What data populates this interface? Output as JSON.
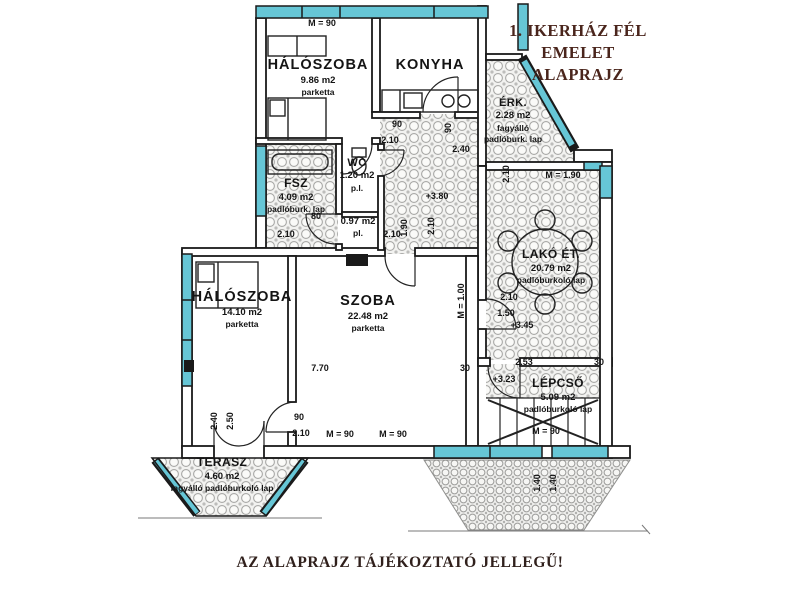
{
  "title": {
    "line1": "1. IKERHÁZ FÉL",
    "line2": "EMELET",
    "line3": "ALAPRAJZ"
  },
  "footer": {
    "disclaimer": "AZ ALAPRAJZ TÁJÉKOZTATÓ JELLEGŰ!"
  },
  "colors": {
    "window_glass": "#66c6d6",
    "wall_ink": "#1a1a1a",
    "title_ink": "#4a251c",
    "footer_ink": "#30201c",
    "tile_hatch": "#a8a8a6",
    "paper": "#ffffff"
  },
  "rooms": [
    {
      "id": "haloszoba-1",
      "name": "HÁLÓSZOBA",
      "area": "9.86 m2",
      "floor": "parketta",
      "x": 318,
      "y": 56,
      "cls": "lg"
    },
    {
      "id": "konyha",
      "name": "KONYHA",
      "x": 430,
      "y": 56,
      "cls": "lg"
    },
    {
      "id": "erkely",
      "name": "ÉRK.",
      "area": "2.28 m2",
      "floor": "fagyálló padlóburk. lap",
      "x": 513,
      "y": 96,
      "cls": "",
      "w": 64
    },
    {
      "id": "furdoszoba",
      "name": "FSZ",
      "area": "4.09 m2",
      "floor": "padlóburk. lap",
      "x": 296,
      "y": 176,
      "cls": "md",
      "w": 80
    },
    {
      "id": "wc",
      "name": "WC",
      "area": "1.20 m2",
      "floor": "p.l.",
      "x": 357,
      "y": 156,
      "cls": ""
    },
    {
      "id": "kamra",
      "area": "0.97 m2",
      "floor": "pl.",
      "x": 358,
      "y": 216,
      "cls": ""
    },
    {
      "id": "lako-etkezo",
      "name": "LAKÓ ÉT.",
      "area": "20.79 m2",
      "floor": "padlóburkoló lap",
      "x": 551,
      "y": 247,
      "cls": "md"
    },
    {
      "id": "haloszoba-2",
      "name": "HÁLÓSZOBA",
      "area": "14.10 m2",
      "floor": "parketta",
      "x": 242,
      "y": 288,
      "cls": "lg"
    },
    {
      "id": "szoba",
      "name": "SZOBA",
      "area": "22.48 m2",
      "floor": "parketta",
      "x": 368,
      "y": 292,
      "cls": "lg"
    },
    {
      "id": "lepcso",
      "name": "LÉPCSŐ",
      "area": "5.09 m2",
      "floor": "padlóburkoló lap",
      "x": 558,
      "y": 376,
      "cls": "md"
    },
    {
      "id": "terasz",
      "name": "TERASZ",
      "area": "4.60 m2",
      "floor": "fagyálló padlóburkoló lap",
      "x": 222,
      "y": 455,
      "cls": "md",
      "w": 104
    }
  ],
  "dims": [
    {
      "text": "M = 90",
      "x": 322,
      "y": 23
    },
    {
      "text": "90",
      "x": 397,
      "y": 124
    },
    {
      "text": "2.10",
      "x": 390,
      "y": 140
    },
    {
      "text": "90",
      "x": 448,
      "y": 128,
      "r": 1
    },
    {
      "text": "2.40",
      "x": 461,
      "y": 149
    },
    {
      "text": "+3.80",
      "x": 437,
      "y": 196
    },
    {
      "text": "80",
      "x": 316,
      "y": 216
    },
    {
      "text": "2.10",
      "x": 286,
      "y": 234
    },
    {
      "text": "2.10",
      "x": 392,
      "y": 234
    },
    {
      "text": "1.90",
      "x": 404,
      "y": 228,
      "r": 1
    },
    {
      "text": "2.10",
      "x": 431,
      "y": 226,
      "r": 1
    },
    {
      "text": "2.10",
      "x": 506,
      "y": 174,
      "r": 1
    },
    {
      "text": "M = 1.90",
      "x": 563,
      "y": 175
    },
    {
      "text": "2.10",
      "x": 509,
      "y": 297
    },
    {
      "text": "1.50",
      "x": 506,
      "y": 313
    },
    {
      "text": "+3.45",
      "x": 522,
      "y": 325
    },
    {
      "text": "M = 1.00",
      "x": 461,
      "y": 301,
      "r": 1
    },
    {
      "text": "30",
      "x": 465,
      "y": 368
    },
    {
      "text": "7.70",
      "x": 320,
      "y": 368
    },
    {
      "text": "2.53",
      "x": 524,
      "y": 362
    },
    {
      "text": "30",
      "x": 599,
      "y": 362
    },
    {
      "text": "+3.23",
      "x": 504,
      "y": 379
    },
    {
      "text": "90",
      "x": 299,
      "y": 417
    },
    {
      "text": "2.10",
      "x": 301,
      "y": 433
    },
    {
      "text": "M = 90",
      "x": 340,
      "y": 434
    },
    {
      "text": "M = 90",
      "x": 393,
      "y": 434
    },
    {
      "text": "2.40",
      "x": 214,
      "y": 421,
      "r": 1
    },
    {
      "text": "2.50",
      "x": 230,
      "y": 421,
      "r": 1
    },
    {
      "text": "M = 90",
      "x": 546,
      "y": 431
    },
    {
      "text": "1.40",
      "x": 537,
      "y": 483,
      "r": 1
    },
    {
      "text": "1.40",
      "x": 553,
      "y": 483,
      "r": 1
    }
  ]
}
